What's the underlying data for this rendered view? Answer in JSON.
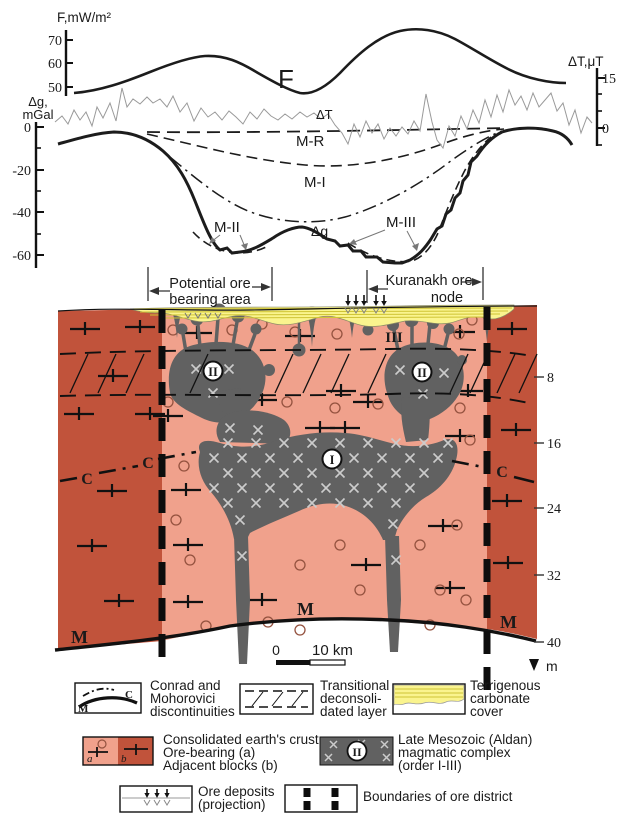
{
  "colors": {
    "salmon": "#f0a18c",
    "dark_red": "#c1533b",
    "gray_body": "#616161",
    "yellow": "#faf48e",
    "yellow_line": "#cfc435",
    "x_mark": "#cccccc",
    "ring": "#94523f",
    "curve_gray": "#9a9a9a"
  },
  "profile": {
    "f_axis": {
      "title": "F,mW/m²",
      "ticks": [
        "70",
        "60",
        "50"
      ]
    },
    "dg_axis": {
      "title1": "Δg,",
      "title2": "mGal",
      "ticks": [
        "0",
        "-20",
        "-40",
        "-60"
      ]
    },
    "dt_axis": {
      "title": "ΔT,μT",
      "ticks": [
        "15",
        "0"
      ]
    },
    "labels": {
      "f": "F",
      "dt": "ΔT",
      "mr": "M-R",
      "mi": "M-I",
      "mii": "M-II",
      "miii": "M-III",
      "dg": "Δg"
    }
  },
  "annotations": {
    "potential": {
      "line1": "Potential ore",
      "line2": "bearing area"
    },
    "kuranakh": {
      "line1": "Kuranakh ore",
      "line2": "node"
    }
  },
  "section": {
    "body_labels": {
      "i": "I",
      "ii": "II",
      "iii": "III"
    },
    "c_label": "C",
    "m_label": "M",
    "depth": {
      "ticks": [
        "8",
        "16",
        "24",
        "32",
        "40"
      ],
      "unit": "m"
    },
    "scale": {
      "zero": "0",
      "len": "10 km"
    }
  },
  "legend": {
    "row1": [
      {
        "label_lines": [
          "Conrad and",
          "Mohorovici",
          "discontinuities"
        ],
        "sym_c": "C",
        "sym_m": "M"
      },
      {
        "label_lines": [
          "Transitional",
          "deconsoli-",
          "dated layer"
        ]
      },
      {
        "label_lines": [
          "Terrigenous",
          "carbonate",
          "cover"
        ]
      }
    ],
    "row2": [
      {
        "label_lines": [
          "Consolidated earth's crust:",
          "Ore-bearing (a)",
          "Adjacent blocks (b)"
        ],
        "sym_a": "a",
        "sym_b": "b"
      },
      {
        "label_lines": [
          "Late Mesozoic (Aldan)",
          "magmatic complex",
          "(order I-III)"
        ],
        "sym": "II"
      }
    ],
    "row3": [
      {
        "label_lines": [
          "Ore deposits",
          "(projection)"
        ]
      },
      {
        "label_lines": [
          "Boundaries of ore district"
        ]
      }
    ]
  }
}
